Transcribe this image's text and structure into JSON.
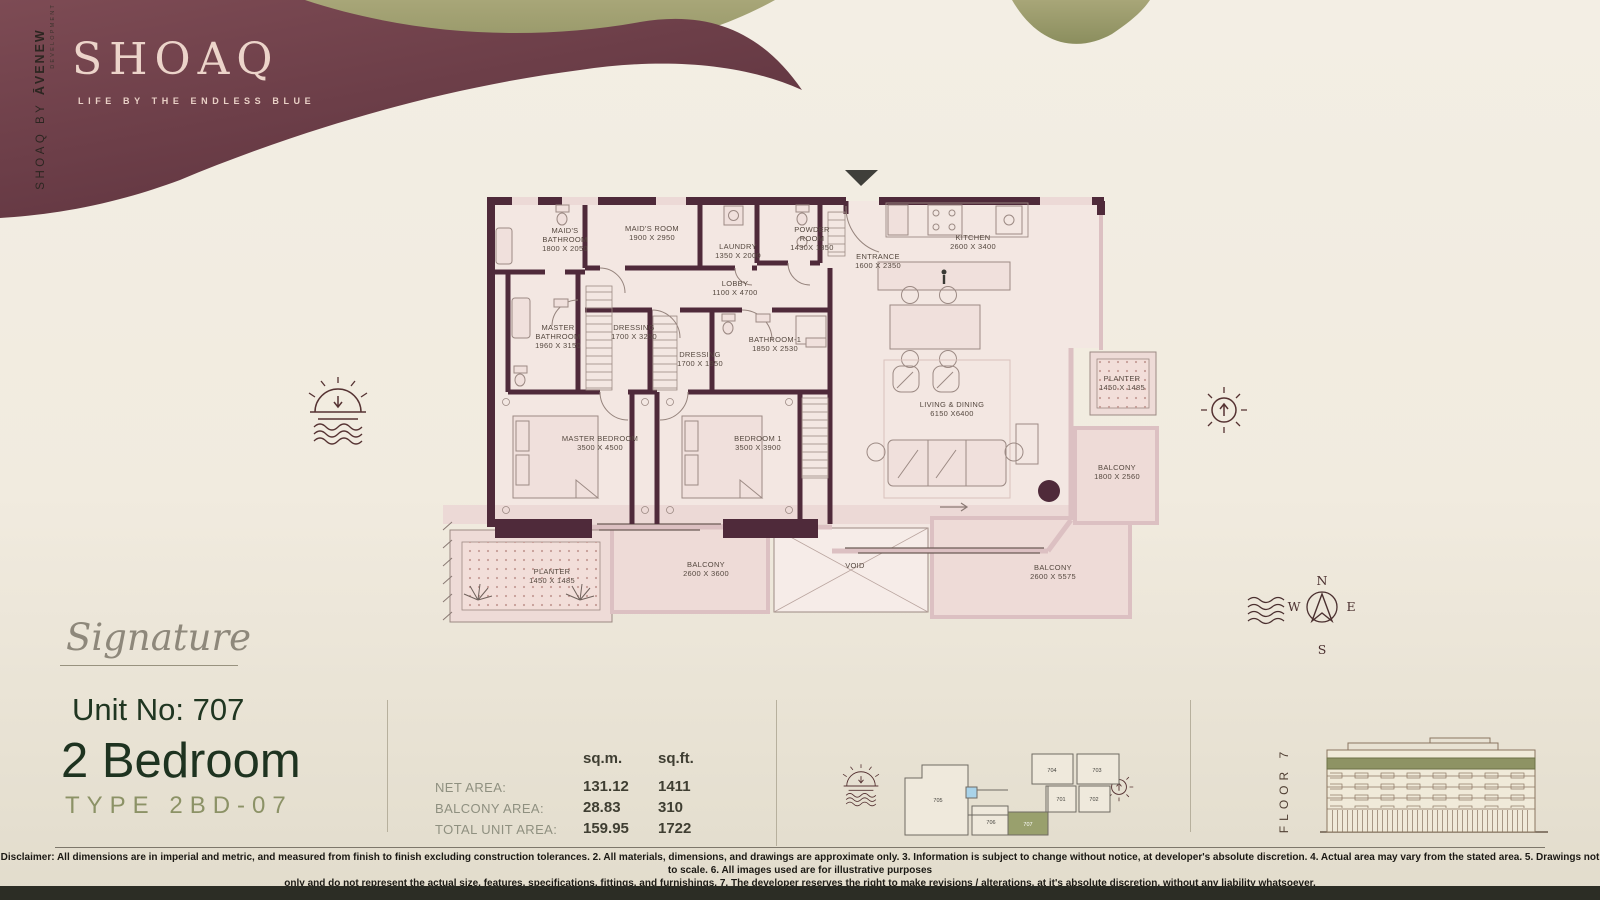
{
  "brand": {
    "logo": "SHOAQ",
    "tagline": "LIFE BY THE ENDLESS BLUE",
    "vertical_a": "SHOAQ BY ",
    "vertical_b": "ĀVENEW",
    "vertical_sub": "DEVELOPMENT"
  },
  "unit": {
    "collection": "Signature",
    "unit_no": "Unit No: 707",
    "type_name": "2 Bedroom",
    "type_code": "TYPE 2BD-07"
  },
  "areas": {
    "col_m": "sq.m.",
    "col_ft": "sq.ft.",
    "rows": [
      {
        "label": "NET AREA:",
        "m": "131.12",
        "ft": "1411"
      },
      {
        "label": "BALCONY AREA:",
        "m": "28.83",
        "ft": "310"
      },
      {
        "label": "TOTAL UNIT AREA:",
        "m": "159.95",
        "ft": "1722"
      }
    ]
  },
  "floor": {
    "label": "FLOOR 7"
  },
  "compass": {
    "n": "N",
    "e": "E",
    "s": "S",
    "w": "W"
  },
  "keyplan": {
    "highlight_color": "#99a06d",
    "units": [
      {
        "id": "705",
        "x": 938,
        "y": 802,
        "hl": false
      },
      {
        "id": "706",
        "x": 991,
        "y": 824,
        "hl": false
      },
      {
        "id": "707",
        "x": 1028,
        "y": 826,
        "hl": true
      },
      {
        "id": "701",
        "x": 1061,
        "y": 801,
        "hl": false
      },
      {
        "id": "702",
        "x": 1094,
        "y": 801,
        "hl": false
      },
      {
        "id": "704",
        "x": 1052,
        "y": 772,
        "hl": false
      },
      {
        "id": "703",
        "x": 1097,
        "y": 772,
        "hl": false
      }
    ]
  },
  "floorplan": {
    "wall_color": "#4f2a3a",
    "rooms": [
      {
        "lines": [
          "MAID'S",
          "BATHROOM",
          "1800 X 2050"
        ],
        "x": 565,
        "y": 233
      },
      {
        "lines": [
          "MAID'S ROOM",
          "1900 X 2950"
        ],
        "x": 652,
        "y": 231
      },
      {
        "lines": [
          "LAUNDRY",
          "1350 X 2000"
        ],
        "x": 738,
        "y": 249
      },
      {
        "lines": [
          "POWDER",
          "ROOM",
          "1430X 1850"
        ],
        "x": 812,
        "y": 232
      },
      {
        "lines": [
          "ENTRANCE",
          "1600 X 2350"
        ],
        "x": 878,
        "y": 259
      },
      {
        "lines": [
          "KITCHEN",
          "2600 X 3400"
        ],
        "x": 973,
        "y": 240
      },
      {
        "lines": [
          "LOBBY",
          "1100 X 4700"
        ],
        "x": 735,
        "y": 286
      },
      {
        "lines": [
          "MASTER",
          "BATHROOM",
          "1960 X 3150"
        ],
        "x": 558,
        "y": 330
      },
      {
        "lines": [
          "DRESSING",
          "1700 X 3250"
        ],
        "x": 634,
        "y": 330
      },
      {
        "lines": [
          "DRESSING",
          "1700 X 1950"
        ],
        "x": 700,
        "y": 357
      },
      {
        "lines": [
          "BATHROOM-1",
          "1850 X 2530"
        ],
        "x": 775,
        "y": 342
      },
      {
        "lines": [
          "MASTER BEDROOM",
          "3500 X 4500"
        ],
        "x": 600,
        "y": 441
      },
      {
        "lines": [
          "BEDROOM 1",
          "3500 X 3900"
        ],
        "x": 758,
        "y": 441
      },
      {
        "lines": [
          "LIVING & DINING",
          "6150 X6400"
        ],
        "x": 952,
        "y": 407
      },
      {
        "lines": [
          "PLANTER",
          "1450 X 1485"
        ],
        "x": 1122,
        "y": 381
      },
      {
        "lines": [
          "BALCONY",
          "1800 X 2560"
        ],
        "x": 1117,
        "y": 470
      },
      {
        "lines": [
          "PLANTER",
          "1450 X 1485"
        ],
        "x": 552,
        "y": 574
      },
      {
        "lines": [
          "BALCONY",
          "2600 X 3600"
        ],
        "x": 706,
        "y": 567
      },
      {
        "lines": [
          "VOID"
        ],
        "x": 855,
        "y": 568
      },
      {
        "lines": [
          "BALCONY",
          "2600 X 5575"
        ],
        "x": 1053,
        "y": 570
      }
    ]
  },
  "disclaimer": {
    "line1": "Disclaimer: All dimensions are in imperial and metric, and measured from finish to finish excluding construction tolerances. 2. All materials, dimensions, and drawings are approximate only. 3. Information is subject to change without notice, at developer's absolute discretion. 4. Actual area may vary from the stated area. 5. Drawings not to scale. 6. All images used are for illustrative purposes",
    "line2": "only and do not represent the actual size, features, specifications, fittings, and furnishings. 7. The developer reserves the right to make revisions / alterations, at it's absolute discretion, without any liability whatsoever."
  }
}
